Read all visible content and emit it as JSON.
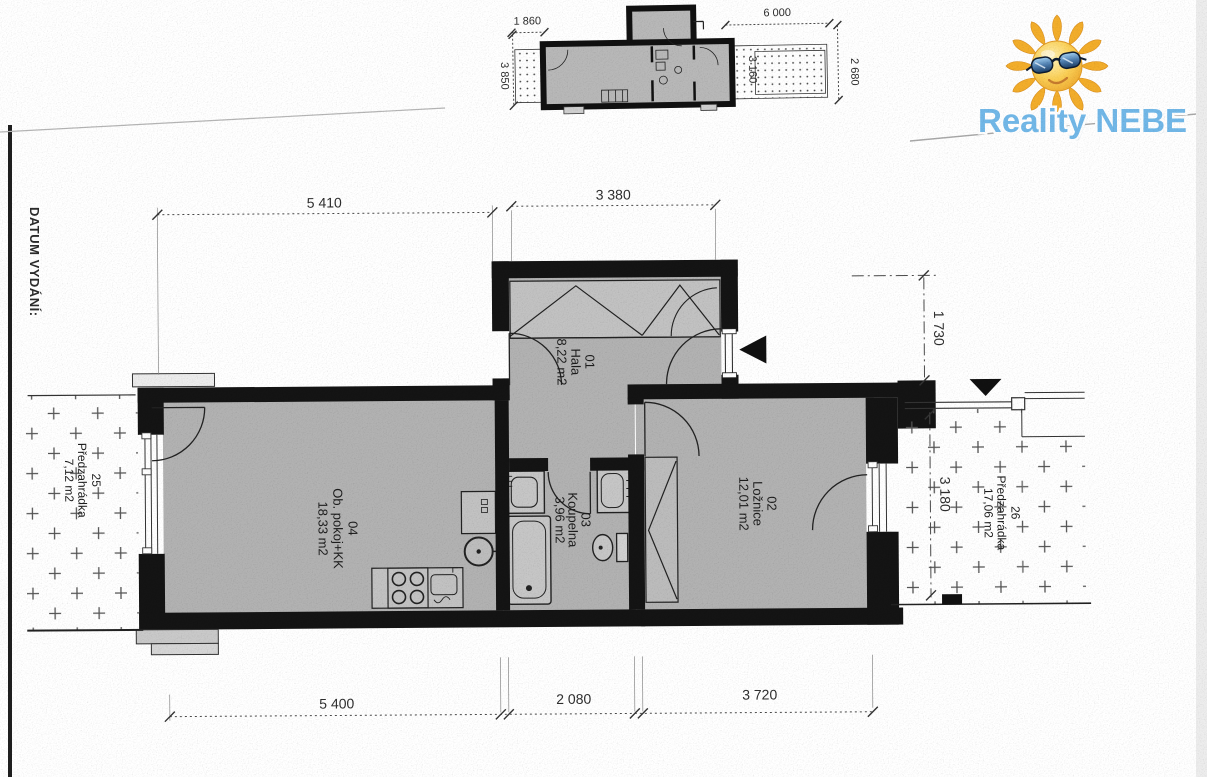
{
  "page": {
    "datum_vydani_label": "DATUM VYDÁNÍ:"
  },
  "logo": {
    "text": "Reality NEBE",
    "icon": "sun-with-sunglasses-icon",
    "text_color": "#72b8e8"
  },
  "mini_plan": {
    "dim_top_left": "1 860",
    "dim_top_right": "6 000",
    "dim_left": "3 850",
    "dim_inner": "3 160",
    "dim_right": "2 680"
  },
  "main_plan": {
    "dim_top_left": "5 410",
    "dim_top_center": "3 380",
    "dim_right_top": "1 730",
    "dim_right_garden": "3 180",
    "dim_bottom_left": "5 400",
    "dim_bottom_center": "2 080",
    "dim_bottom_right": "3 720",
    "rooms": [
      {
        "number": "01",
        "name": "Hala",
        "area": "8,22 m2"
      },
      {
        "number": "02",
        "name": "Ložnice",
        "area": "12,01 m2"
      },
      {
        "number": "03",
        "name": "Koupelna",
        "area": "3,96 m2"
      },
      {
        "number": "04",
        "name": "Ob. pokoj+KK",
        "area": "18,33 m2"
      },
      {
        "number": "25",
        "name": "Předzahrádka",
        "area": "7,12 m2"
      },
      {
        "number": "26",
        "name": "Předzahrádka",
        "area": "17,06 m2"
      }
    ]
  },
  "colors": {
    "wall": "#141414",
    "room_fill": "#b2b2b2",
    "logo_blue": "#72b8e8",
    "sun_yellow": "#f6c243"
  }
}
